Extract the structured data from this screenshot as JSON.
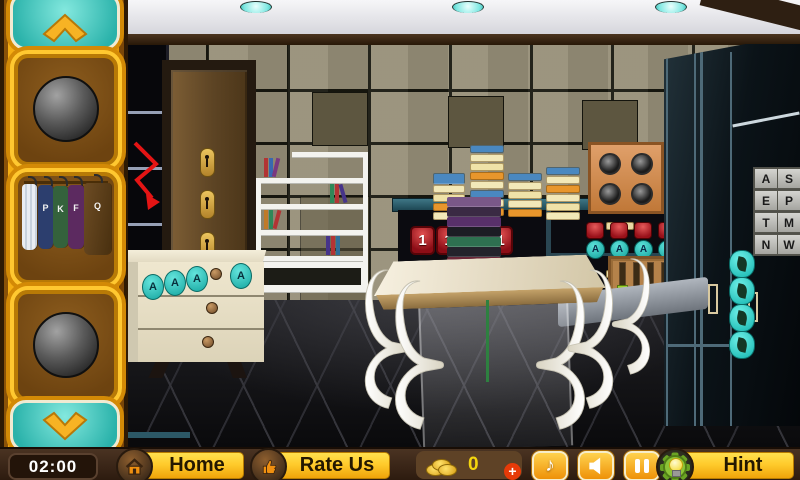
{
  "hud": {
    "timer": "02:00",
    "home_label": "Home",
    "rate_label": "Rate Us",
    "coins_value": "0",
    "coins_add_label": "+",
    "hint_label": "Hint",
    "music_icon_glyph": "♪"
  },
  "sidebar": {
    "clothes_letters": [
      "P",
      "K",
      "F",
      "Q"
    ]
  },
  "scene": {
    "code_display": [
      "1",
      "1",
      "1",
      "1"
    ],
    "dresser_buttons": [
      "A",
      "A",
      "A",
      "A"
    ],
    "panel_buttons": [
      "A",
      "A",
      "A",
      "A",
      "A"
    ],
    "letter_grid": [
      "A",
      "S",
      "E",
      "P",
      "T",
      "M",
      "N",
      "W"
    ]
  },
  "icons": {
    "sidebar_up": "chevron-up",
    "sidebar_down": "chevron-down",
    "home": "house",
    "rate": "thumb-up",
    "coins": "coin-stack",
    "add_coins": "plus",
    "music": "music-note",
    "sound": "speaker",
    "pause": "pause-bars",
    "hint": "bulb-in-gear"
  },
  "colors": {
    "gold": "#f2ac14",
    "teal": "#30c4bc",
    "hud_brown": "#3a2517",
    "button_yellow": "#ffd234",
    "code_red": "#a81420",
    "add_red": "#e63a08"
  }
}
